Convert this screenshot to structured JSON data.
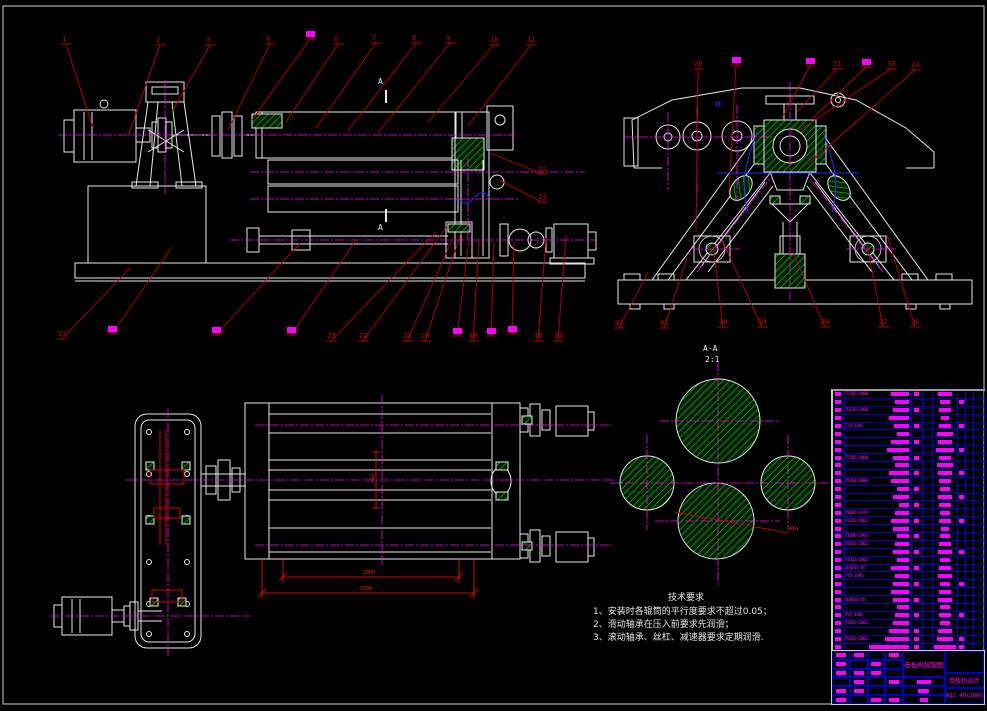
{
  "colors": {
    "background": "#000000",
    "line": "#e8e8e8",
    "centerline": "#ff00ff",
    "leader": "#c00000",
    "hatch": "#00c800",
    "table_grid": "#0000cc",
    "quicktext": "#ff00ff"
  },
  "section_view": {
    "label": "A-A",
    "scale": "2:1",
    "cut_label": "A",
    "leader_label": "41a"
  },
  "tech_requirements": {
    "title": "技术要求",
    "lines": [
      "1、安装时各辊筒的平行度要求不超过0.05；",
      "2、滑动轴承在压入前要求先润滑；",
      "3、滚动轴承、丝杠、减速器要求定期润滑."
    ]
  },
  "dimensions": {
    "roller_length": "2000",
    "overall_length": "2500",
    "roller_dia": "Φ320"
  },
  "title_block": {
    "drawing_name": "卷板机装配图",
    "project": "卷板机设计",
    "model": "W12 40x2000"
  },
  "balloons": {
    "front_top": [
      {
        "t": "1",
        "x": 62,
        "y": 36,
        "tx": 93,
        "ty": 128
      },
      {
        "t": "2",
        "x": 156,
        "y": 37,
        "tx": 128,
        "ty": 136
      },
      {
        "t": "3",
        "x": 206,
        "y": 37,
        "tx": 172,
        "ty": 112
      },
      {
        "t": "4",
        "x": 266,
        "y": 36,
        "tx": 228,
        "ty": 130
      },
      {
        "t": "#",
        "x": 306,
        "y": 31,
        "tx": 252,
        "ty": 120
      },
      {
        "t": "6",
        "x": 334,
        "y": 36,
        "tx": 286,
        "ty": 122
      },
      {
        "t": "7",
        "x": 372,
        "y": 35,
        "tx": 316,
        "ty": 128
      },
      {
        "t": "8",
        "x": 412,
        "y": 35,
        "tx": 348,
        "ty": 131
      },
      {
        "t": "9",
        "x": 446,
        "y": 35,
        "tx": 378,
        "ty": 133
      },
      {
        "t": "10",
        "x": 490,
        "y": 37,
        "tx": 428,
        "ty": 122
      },
      {
        "t": "11",
        "x": 527,
        "y": 37,
        "tx": 468,
        "ty": 126
      }
    ],
    "front_right": [
      {
        "t": "12",
        "x": 538,
        "y": 166,
        "tx": 490,
        "ty": 153
      },
      {
        "t": "13",
        "x": 538,
        "y": 194,
        "tx": 499,
        "ty": 180
      }
    ],
    "front_bottom": [
      {
        "t": "27",
        "x": 58,
        "y": 331,
        "tx": 130,
        "ty": 268
      },
      {
        "t": "#",
        "x": 108,
        "y": 326,
        "tx": 172,
        "ty": 247
      },
      {
        "t": "#",
        "x": 212,
        "y": 327,
        "tx": 300,
        "ty": 243
      },
      {
        "t": "#",
        "x": 287,
        "y": 327,
        "tx": 356,
        "ty": 240
      },
      {
        "t": "23",
        "x": 327,
        "y": 333,
        "tx": 436,
        "ty": 232
      },
      {
        "t": "22",
        "x": 359,
        "y": 333,
        "tx": 447,
        "ty": 226
      },
      {
        "t": "21",
        "x": 403,
        "y": 333,
        "tx": 453,
        "ty": 238
      },
      {
        "t": "20",
        "x": 421,
        "y": 333,
        "tx": 461,
        "ty": 233
      },
      {
        "t": "#",
        "x": 453,
        "y": 328,
        "tx": 469,
        "ty": 240
      },
      {
        "t": "18",
        "x": 469,
        "y": 333,
        "tx": 479,
        "ty": 238
      },
      {
        "t": "#",
        "x": 487,
        "y": 328,
        "tx": 494,
        "ty": 242
      },
      {
        "t": "#",
        "x": 508,
        "y": 326,
        "tx": 514,
        "ty": 242
      },
      {
        "t": "15",
        "x": 534,
        "y": 333,
        "tx": 546,
        "ty": 238
      },
      {
        "t": "14",
        "x": 554,
        "y": 333,
        "tx": 566,
        "ty": 235
      }
    ],
    "side_top": [
      {
        "t": "28",
        "x": 694,
        "y": 61,
        "tx": 696,
        "ty": 232
      },
      {
        "t": "#",
        "x": 732,
        "y": 57,
        "tx": 729,
        "ty": 192
      },
      {
        "t": "#",
        "x": 806,
        "y": 58,
        "tx": 782,
        "ty": 118
      },
      {
        "t": "31",
        "x": 833,
        "y": 61,
        "tx": 797,
        "ty": 112
      },
      {
        "t": "#",
        "x": 862,
        "y": 59,
        "tx": 813,
        "ty": 118
      },
      {
        "t": "33",
        "x": 887,
        "y": 61,
        "tx": 800,
        "ty": 130
      },
      {
        "t": "34",
        "x": 911,
        "y": 62,
        "tx": 807,
        "ty": 165
      }
    ],
    "side_bottom": [
      {
        "t": "42",
        "x": 615,
        "y": 320,
        "tx": 648,
        "ty": 272
      },
      {
        "t": "41",
        "x": 660,
        "y": 320,
        "tx": 687,
        "ty": 258
      },
      {
        "t": "40",
        "x": 719,
        "y": 319,
        "tx": 713,
        "ty": 245
      },
      {
        "t": "39",
        "x": 758,
        "y": 319,
        "tx": 722,
        "ty": 240
      },
      {
        "t": "38",
        "x": 821,
        "y": 319,
        "tx": 792,
        "ty": 250
      },
      {
        "t": "32",
        "x": 879,
        "y": 319,
        "tx": 867,
        "ty": 245
      },
      {
        "t": "36",
        "x": 911,
        "y": 319,
        "tx": 887,
        "ty": 235
      }
    ]
  },
  "parts_list": {
    "rows": [
      {
        "c": "T5782-2000",
        "nb": 18,
        "q": 1,
        "m": 14,
        "r": 0
      },
      {
        "c": null,
        "nb": 14,
        "q": 0,
        "m": 10,
        "r": 1
      },
      {
        "c": "T6170-2000",
        "nb": 16,
        "q": 1,
        "m": 12,
        "r": 0
      },
      {
        "c": null,
        "nb": 20,
        "q": 0,
        "m": 8,
        "r": 0
      },
      {
        "c": "T75-1985",
        "nb": 15,
        "q": 1,
        "m": 12,
        "r": 1
      },
      {
        "c": null,
        "nb": 12,
        "q": 0,
        "m": 16,
        "r": 0
      },
      {
        "c": null,
        "nb": 18,
        "q": 1,
        "m": 14,
        "r": 0
      },
      {
        "c": null,
        "nb": 22,
        "q": 0,
        "m": 18,
        "r": 1
      },
      {
        "c": "T5782-2000",
        "nb": 16,
        "q": 1,
        "m": 12,
        "r": 0
      },
      {
        "c": null,
        "nb": 14,
        "q": 0,
        "m": 16,
        "r": 0
      },
      {
        "c": null,
        "nb": 20,
        "q": 1,
        "m": 14,
        "r": 1
      },
      {
        "c": "T5782-2000",
        "nb": 18,
        "q": 0,
        "m": 12,
        "r": 0
      },
      {
        "c": null,
        "nb": 12,
        "q": 1,
        "m": 10,
        "r": 0
      },
      {
        "c": null,
        "nb": 16,
        "q": 0,
        "m": 14,
        "r": 1
      },
      {
        "c": null,
        "nb": 10,
        "q": 1,
        "m": 12,
        "r": 0
      },
      {
        "c": "T1095-1979",
        "nb": 14,
        "q": 0,
        "m": 10,
        "r": 0
      },
      {
        "c": "T4323-2002",
        "nb": 18,
        "q": 1,
        "m": 12,
        "r": 1
      },
      {
        "c": null,
        "nb": 16,
        "q": 0,
        "m": 8,
        "r": 0
      },
      {
        "c": "T1096-1994",
        "nb": 12,
        "q": 1,
        "m": 10,
        "r": 0
      },
      {
        "c": "T4323-2002",
        "nb": 14,
        "q": 0,
        "m": 12,
        "r": 0
      },
      {
        "c": null,
        "nb": 16,
        "q": 1,
        "m": 14,
        "r": 1
      },
      {
        "c": "T4323-2002",
        "nb": 12,
        "q": 0,
        "m": 10,
        "r": 0
      },
      {
        "c": "JB4616-85",
        "nb": 18,
        "q": 1,
        "m": 12,
        "r": 0
      },
      {
        "c": "T75-1985",
        "nb": 14,
        "q": 0,
        "m": 14,
        "r": 0
      },
      {
        "c": null,
        "nb": 16,
        "q": 1,
        "m": 10,
        "r": 1
      },
      {
        "c": null,
        "nb": 18,
        "q": 0,
        "m": 12,
        "r": 0
      },
      {
        "c": "JB4616-85",
        "nb": 16,
        "q": 1,
        "m": 14,
        "r": 0
      },
      {
        "c": null,
        "nb": 12,
        "q": 0,
        "m": 10,
        "r": 0
      },
      {
        "c": "T75-1985",
        "nb": 14,
        "q": 1,
        "m": 12,
        "r": 1
      },
      {
        "c": "T4323-2002",
        "nb": 16,
        "q": 0,
        "m": 10,
        "r": 0
      },
      {
        "c": null,
        "nb": 20,
        "q": 1,
        "m": 14,
        "r": 0
      },
      {
        "c": "T4323-2002",
        "nb": 24,
        "q": 1,
        "m": 16,
        "r": 1
      },
      {
        "c": null,
        "nb": 40,
        "q": 1,
        "m": 22,
        "r": 1
      }
    ]
  }
}
